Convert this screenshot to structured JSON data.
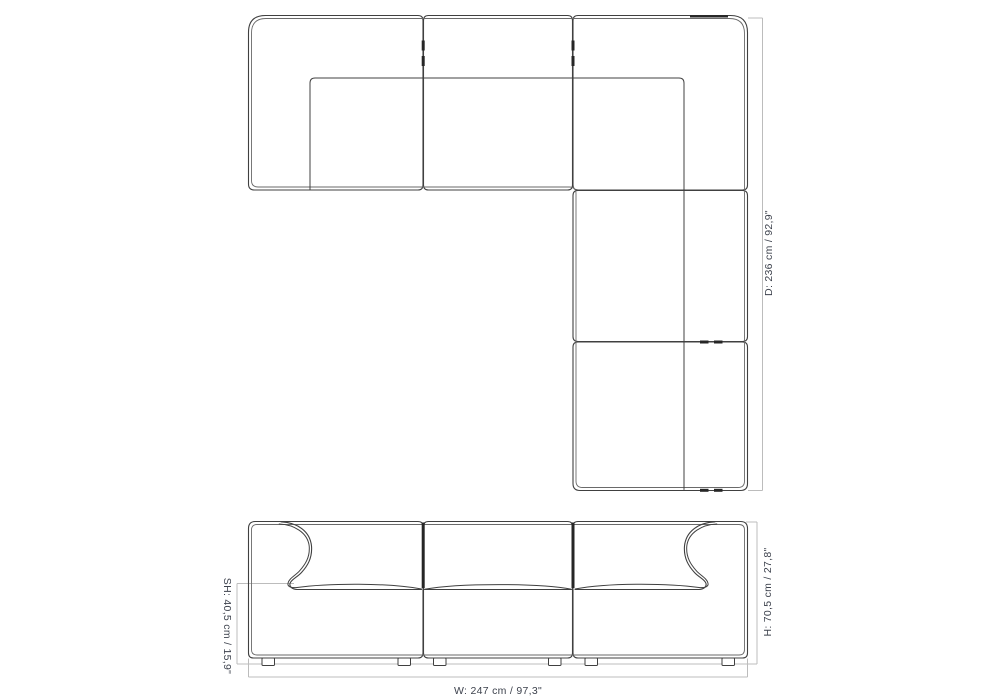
{
  "drawing": {
    "kind": "sofa-dimension-diagram",
    "top_view": {
      "depth_label": "D: 236 cm / 92,9\""
    },
    "front_view": {
      "height_label": "H: 70,5 cm / 27,8\"",
      "seat_height_label": "SH: 40,5 cm / 15,9\"",
      "width_label": "W: 247 cm / 97,3\""
    },
    "colors": {
      "background": "#ffffff",
      "outline": "#404040",
      "dimension_line": "#bcbcbc",
      "label_text": "#3d424d"
    }
  }
}
